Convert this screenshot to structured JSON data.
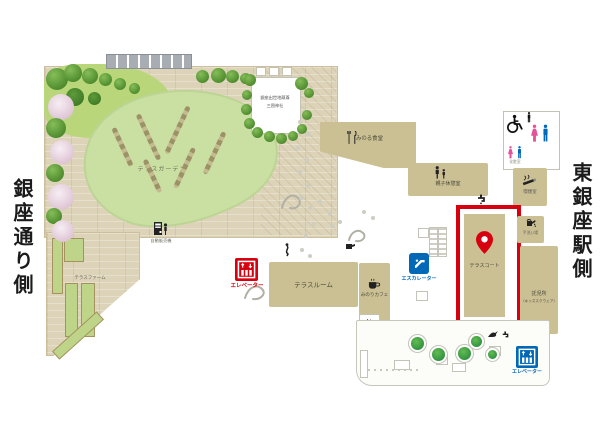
{
  "side_labels": {
    "left": "銀座通り側",
    "right": "東銀座駅側"
  },
  "garden": {
    "terrace_garden": "テラスガーデン",
    "terrace_farm": "テラスファーム",
    "shrine_line1": "銀座出世地蔵尊",
    "shrine_line2": "三囲神社",
    "vending": "自動販売機"
  },
  "rooms": {
    "terrace_room": "テラスルーム",
    "terrace_court": "テラスコート",
    "minoru_dining": "みのる食堂",
    "minori_cafe": "みのりカフェ",
    "oyako_rest": "親子休憩室",
    "kids_line1": "託児所",
    "kids_line2": "（キッズスクウェア）",
    "smoking_top": "喫煙室",
    "smoking_cafe": "喫煙室",
    "restroom_small": "化粧室",
    "hand_wash": "手洗い場"
  },
  "transport": {
    "elevator_left": "エレベーター",
    "elevator_right": "エレベーター",
    "escalator": "エスカレーター"
  },
  "colors": {
    "red": "#d7000f",
    "blue": "#0068b7",
    "pink": "#e4539a",
    "room_beige": "#cbc094",
    "deck_tan": "#ddd3b8",
    "lawn": "#c9e0a2",
    "lawn2": "#b9d77a"
  }
}
